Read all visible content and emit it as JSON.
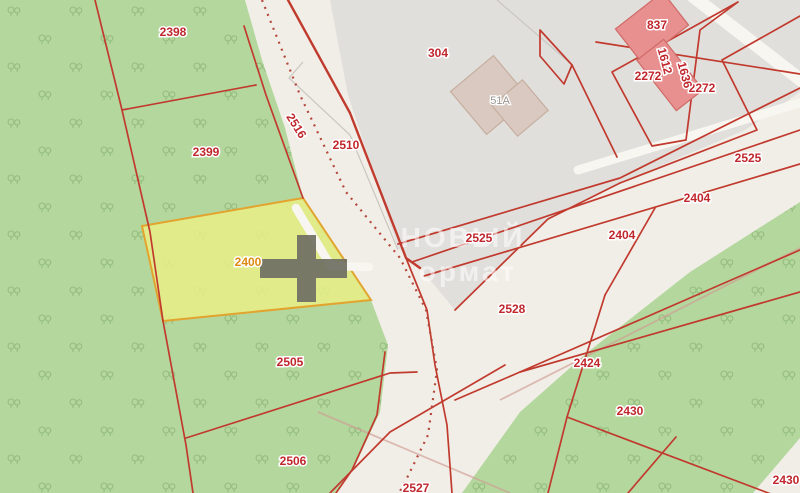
{
  "watermark": {
    "line1": "НОВЫЙ",
    "line2": "ормат"
  },
  "marker_icon": "plus-cross",
  "labels": {
    "l2398": "2398",
    "l2399": "2399",
    "l2400": "2400",
    "l2505": "2505",
    "l2506": "2506",
    "l2516": "2516",
    "l2510": "2510",
    "l304": "304",
    "l51a": "51А",
    "l2525a": "2525",
    "l2528": "2528",
    "l2525b": "2525",
    "l2404a": "2404",
    "l2404b": "2404",
    "l2272a": "2272",
    "l2272b": "2272",
    "l837": "837",
    "l1612": "1612",
    "l1636": "1636",
    "l2424": "2424",
    "l2430a": "2430",
    "l2430b": "2430",
    "l2527": "2527"
  },
  "theme": {
    "c_bg": "#f1eee7",
    "c_green": "#b4d79e",
    "c_tree": "#94bd7e",
    "c_gray": "#e1dfdc",
    "c_redline": "#c13a2e",
    "c_dash": "#b4483c",
    "c_label": "#c0272d",
    "c_label_orange": "#e08a12",
    "c_yellow_fill": "#e9ef86",
    "c_yellow_stroke": "#e2a42e",
    "c_building_red": "#e89090",
    "c_building_red_stroke": "#cf6a66",
    "c_building_tan": "#d9c9c0",
    "c_building_tan_stroke": "#c5ae9e",
    "c_marker": "#6e6e62",
    "c_white_road": "#f8f6f0",
    "c_tan_line": "#cf9d94",
    "c_gray_line": "#c9c6c1",
    "c_wm": "#ffffff"
  }
}
